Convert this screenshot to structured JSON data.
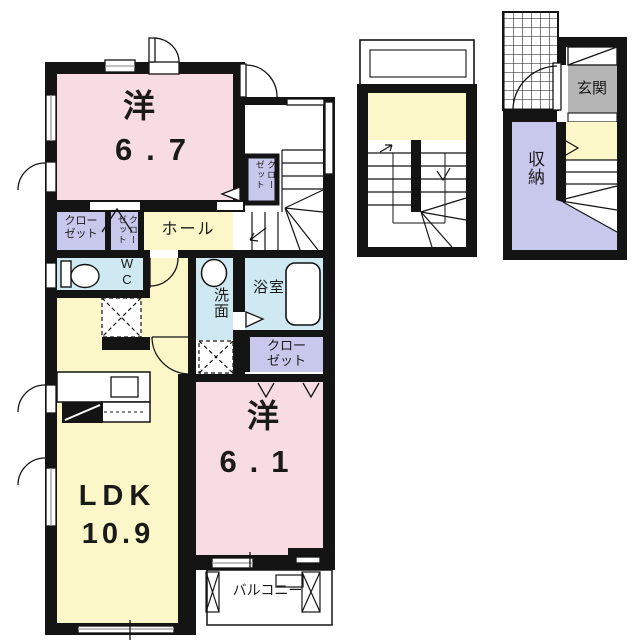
{
  "plan": {
    "upper_floor": {
      "bedroom1": {
        "name": "洋",
        "area": "6.7"
      },
      "closet_nw": {
        "line1": "クロー",
        "line2": "ゼット"
      },
      "closet_nw2": {
        "name": "クローゼット"
      },
      "hall": {
        "name": "ホール"
      },
      "closet_stair": {
        "name": "クローゼット"
      },
      "wc": {
        "line1": "W",
        "line2": "C"
      },
      "washroom": {
        "name": "洗面"
      },
      "bathroom": {
        "name": "浴室"
      },
      "closet_south": {
        "line1": "クロー",
        "line2": "ゼット"
      },
      "bedroom2": {
        "name": "洋",
        "area": "6.1"
      },
      "ldk": {
        "name": "LDK",
        "area": "10.9"
      },
      "balcony": {
        "name": "バルコニー"
      }
    },
    "ground_floor": {
      "entrance": {
        "name": "玄関"
      },
      "storage": {
        "name": "収納"
      }
    },
    "colors": {
      "wall": "#141414",
      "room_pink": "#f8dce3",
      "room_yellow": "#fbf7c9",
      "closet_purple": "#c8c8ec",
      "wet_area_blue": "#cfe9f2",
      "entrance_gray": "#b5b5b5"
    }
  }
}
